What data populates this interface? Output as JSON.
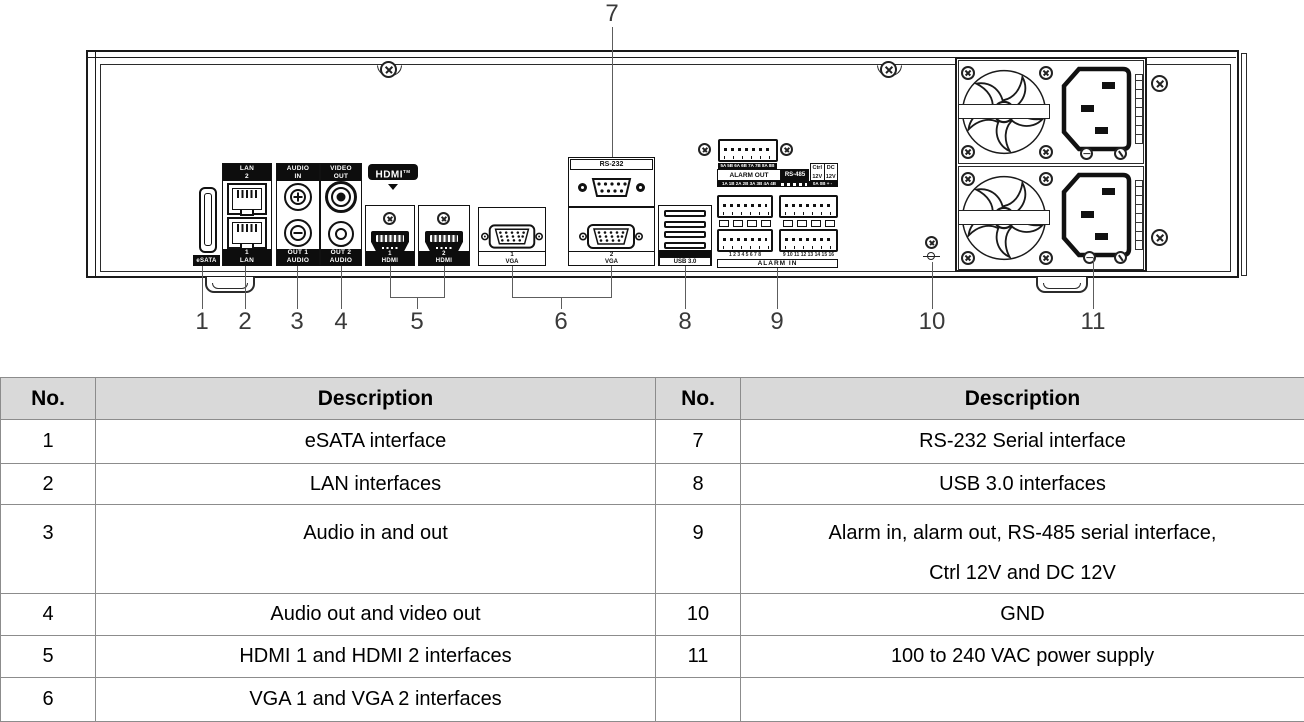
{
  "diagram": {
    "callouts": {
      "c1": "1",
      "c2": "2",
      "c3": "3",
      "c4": "4",
      "c5": "5",
      "c6": "6",
      "c7": "7",
      "c8": "8",
      "c9": "9",
      "c10": "10",
      "c11": "11"
    },
    "labels": {
      "esata": "eSATA",
      "lan_top": {
        "l1": "LAN",
        "l2": "2"
      },
      "lan_bottom": {
        "l1": "1",
        "l2": "LAN"
      },
      "audio_top": {
        "l1": "AUDIO",
        "l2": "IN"
      },
      "audio_bottom": {
        "l1": "OUT 1",
        "l2": "AUDIO"
      },
      "video_top": {
        "l1": "VIDEO",
        "l2": "OUT"
      },
      "video_bottom": {
        "l1": "OUT 2",
        "l2": "AUDIO"
      },
      "hdmi_logo": "HDMI",
      "hdmi_logo_tm": "TM",
      "hdmi1": {
        "l1": "1",
        "l2": "HDMI"
      },
      "hdmi2": {
        "l1": "2",
        "l2": "HDMI"
      },
      "vga1": {
        "l1": "1",
        "l2": "VGA"
      },
      "vga2": {
        "l1": "2",
        "l2": "VGA"
      },
      "rs232": "RS-232",
      "usb": "USB 3.0",
      "alarm_out_pins_top": "5A 5B 6A 6B 7A 7B 8A 8B",
      "alarm_out": "ALARM OUT",
      "rs485": "RS-485",
      "ctrl": "Ctrl",
      "dc": "DC",
      "ctrl_v": "12V",
      "dc_v": "12V",
      "alarm_out_pins_bottom": "1A 1B 2A 2B 3A 3B 4A 4B",
      "ctrl_dc_pins": "0A 0B + -",
      "alarm_in_pins_left": "1 2 3 4 5 6 7 8",
      "alarm_in_pins_right": "9 10 11 12 13 14 15 16",
      "alarm_in": "ALARM IN"
    }
  },
  "table": {
    "left": {
      "header": {
        "no": "No.",
        "description": "Description"
      },
      "rows": [
        {
          "no": "1",
          "description": "eSATA interface"
        },
        {
          "no": "2",
          "description": "LAN interfaces"
        },
        {
          "no": "3",
          "description": "Audio in and out"
        },
        {
          "no": "4",
          "description": "Audio out and video out"
        },
        {
          "no": "5",
          "description": "HDMI 1 and HDMI 2 interfaces"
        },
        {
          "no": "6",
          "description": "VGA 1 and VGA 2 interfaces"
        }
      ]
    },
    "right": {
      "header": {
        "no": "No.",
        "description": "Description"
      },
      "rows": [
        {
          "no": "7",
          "description": "RS-232 Serial interface"
        },
        {
          "no": "8",
          "description": "USB 3.0 interfaces"
        },
        {
          "no": "9",
          "description": "Alarm in, alarm out, RS-485 serial interface,",
          "description2": "Ctrl 12V and DC 12V"
        },
        {
          "no": "10",
          "description": "GND"
        },
        {
          "no": "11",
          "description": "100 to 240 VAC power supply"
        },
        {
          "no": "",
          "description": ""
        }
      ]
    }
  }
}
